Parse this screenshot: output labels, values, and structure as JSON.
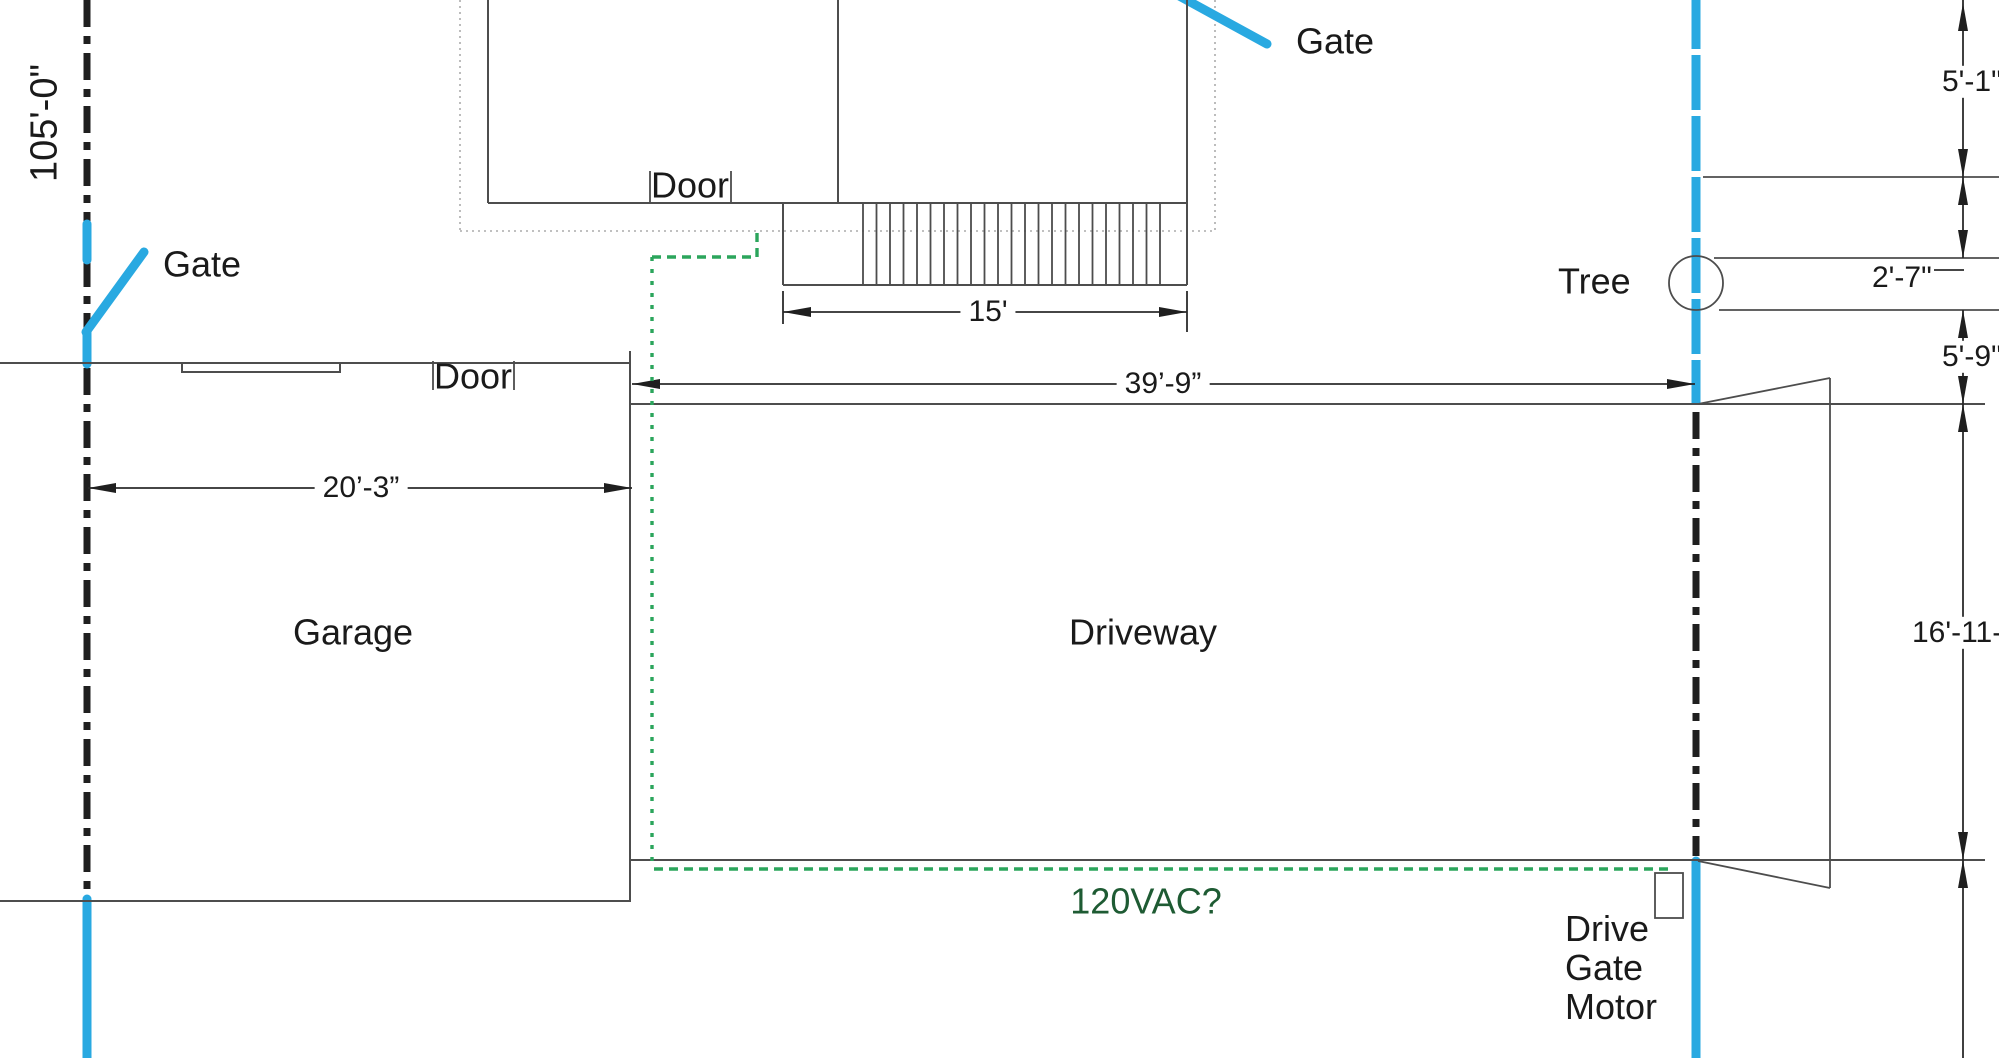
{
  "colors": {
    "fence_blue": "#29A9E1",
    "conduit_green": "#2BA55C",
    "power_text_green": "#1E5B33",
    "property_line_dark": "#1F1F1F",
    "wall_gray": "#4D4D4D"
  },
  "labels": {
    "boundary_length": "105'-0\"",
    "gate_left": "Gate",
    "gate_top": "Gate",
    "door_top": "Door",
    "door_garage": "Door",
    "tree": "Tree",
    "garage": "Garage",
    "driveway": "Driveway",
    "power": "120VAC?",
    "drive_gate_motor": "Drive\nGate\nMotor"
  },
  "dims": {
    "stairs_width": "15'",
    "driveway_length": "39’-9”",
    "garage_width": "20’-3”",
    "right_top": "5'-1\"",
    "tree_offset": "2'-7\"",
    "tree_to_driveway": "5'-9\"",
    "driveway_width": "16'-11-1/2\""
  },
  "shapes": [
    {
      "name": "house-outer-dotted-left",
      "t": "line",
      "x1": 460,
      "y1": 0,
      "x2": 460,
      "y2": 231,
      "cls": "dotted"
    },
    {
      "name": "house-outer-dotted-bottom",
      "t": "line",
      "x1": 460,
      "y1": 231,
      "x2": 1215,
      "y2": 231,
      "cls": "dotted"
    },
    {
      "name": "house-outer-dotted-right",
      "t": "line",
      "x1": 1215,
      "y1": 0,
      "x2": 1215,
      "y2": 231,
      "cls": "dotted"
    },
    {
      "name": "left-property-line-upper",
      "t": "line",
      "x1": 87,
      "y1": 0,
      "x2": 87,
      "y2": 226,
      "cls": "prop"
    },
    {
      "name": "left-property-line-mid",
      "t": "line",
      "x1": 87,
      "y1": 260,
      "x2": 87,
      "y2": 331,
      "cls": "prop"
    },
    {
      "name": "left-property-line-lower",
      "t": "line",
      "x1": 87,
      "y1": 368,
      "x2": 87,
      "y2": 896,
      "cls": "prop"
    },
    {
      "name": "left-fence-blue-upper",
      "t": "line",
      "x1": 87,
      "y1": 224,
      "x2": 87,
      "y2": 260,
      "cls": "blue"
    },
    {
      "name": "left-fence-blue-mid",
      "t": "line",
      "x1": 87,
      "y1": 331,
      "x2": 87,
      "y2": 364,
      "cls": "blue"
    },
    {
      "name": "left-fence-blue-lower",
      "t": "line",
      "x1": 87,
      "y1": 899,
      "x2": 87,
      "y2": 1062,
      "cls": "blue"
    },
    {
      "name": "left-gate-swing-line",
      "t": "line",
      "x1": 86,
      "y1": 332,
      "x2": 144,
      "y2": 252,
      "cls": "blue"
    },
    {
      "name": "right-fence-blue-upper",
      "t": "line",
      "x1": 1696,
      "y1": -6,
      "x2": 1696,
      "y2": 405,
      "cls": "blued"
    },
    {
      "name": "drive-gate-dash-line",
      "t": "line",
      "x1": 1696,
      "y1": 412,
      "x2": 1696,
      "y2": 856,
      "cls": "prop"
    },
    {
      "name": "right-fence-blue-lower",
      "t": "line",
      "x1": 1696,
      "y1": 861,
      "x2": 1696,
      "y2": 1062,
      "cls": "blue"
    },
    {
      "name": "top-gate-swing-line",
      "t": "line",
      "x1": 1172,
      "y1": -8,
      "x2": 1267,
      "y2": 44,
      "cls": "blue"
    },
    {
      "name": "house-left-wall",
      "t": "line",
      "x1": 488,
      "y1": 0,
      "x2": 488,
      "y2": 203,
      "cls": "wall"
    },
    {
      "name": "house-interior-wall",
      "t": "line",
      "x1": 838,
      "y1": 0,
      "x2": 838,
      "y2": 203,
      "cls": "wall"
    },
    {
      "name": "house-right-wall",
      "t": "line",
      "x1": 1187,
      "y1": 0,
      "x2": 1187,
      "y2": 285,
      "cls": "wall"
    },
    {
      "name": "house-bottom-wall",
      "t": "line",
      "x1": 488,
      "y1": 203,
      "x2": 1187,
      "y2": 203,
      "cls": "wall"
    },
    {
      "name": "house-door-jamb-left",
      "t": "line",
      "x1": 650,
      "y1": 171,
      "x2": 650,
      "y2": 203,
      "cls": "thin"
    },
    {
      "name": "house-door-jamb-right",
      "t": "line",
      "x1": 731,
      "y1": 171,
      "x2": 731,
      "y2": 203,
      "cls": "thin"
    },
    {
      "name": "stairs-left-edge",
      "t": "line",
      "x1": 783,
      "y1": 203,
      "x2": 783,
      "y2": 285,
      "cls": "wall"
    },
    {
      "name": "stairs-bottom-edge",
      "t": "line",
      "x1": 783,
      "y1": 285,
      "x2": 1187,
      "y2": 285,
      "cls": "wall"
    },
    {
      "name": "stairs-treads",
      "t": "hatch",
      "x0": 863,
      "x1": 1160,
      "n": 23,
      "y0": 203,
      "y1": 285,
      "cls": "thin"
    },
    {
      "name": "garage-top-edge",
      "t": "line",
      "x1": 0,
      "y1": 363,
      "x2": 630,
      "y2": 363,
      "cls": "wall"
    },
    {
      "name": "garage-window",
      "t": "rect",
      "x": 182,
      "y": 363,
      "w": 158,
      "h": 9,
      "cls": "wall",
      "fill": "#FFFFFF"
    },
    {
      "name": "garage-door-jamb-left",
      "t": "line",
      "x1": 433,
      "y1": 361,
      "x2": 433,
      "y2": 390,
      "cls": "thin"
    },
    {
      "name": "garage-door-jamb-right",
      "t": "line",
      "x1": 514,
      "y1": 361,
      "x2": 514,
      "y2": 390,
      "cls": "thin"
    },
    {
      "name": "garage-right-edge",
      "t": "line",
      "x1": 630,
      "y1": 351,
      "x2": 630,
      "y2": 902,
      "cls": "wall"
    },
    {
      "name": "garage-bottom-edge",
      "t": "line",
      "x1": 0,
      "y1": 901,
      "x2": 630,
      "y2": 901,
      "cls": "wall"
    },
    {
      "name": "driveway-top-edge",
      "t": "line",
      "x1": 630,
      "y1": 404,
      "x2": 1985,
      "y2": 404,
      "cls": "wall"
    },
    {
      "name": "driveway-bottom-edge",
      "t": "line",
      "x1": 630,
      "y1": 860,
      "x2": 1985,
      "y2": 860,
      "cls": "wall"
    },
    {
      "name": "gate-flare-top",
      "t": "line",
      "x1": 1698,
      "y1": 404,
      "x2": 1830,
      "y2": 378,
      "cls": "thin"
    },
    {
      "name": "gate-flare-right",
      "t": "line",
      "x1": 1830,
      "y1": 378,
      "x2": 1830,
      "y2": 888,
      "cls": "thin"
    },
    {
      "name": "gate-flare-bottom",
      "t": "line",
      "x1": 1698,
      "y1": 861,
      "x2": 1830,
      "y2": 888,
      "cls": "thin"
    },
    {
      "name": "tree-upper-ext-line",
      "t": "line",
      "x1": 1703,
      "y1": 177,
      "x2": 1999,
      "y2": 177,
      "cls": "thin"
    },
    {
      "name": "tree-band-top-line",
      "t": "line",
      "x1": 1714,
      "y1": 258,
      "x2": 1999,
      "y2": 258,
      "cls": "thin"
    },
    {
      "name": "tree-band-bottom-line",
      "t": "line",
      "x1": 1719,
      "y1": 310,
      "x2": 1999,
      "y2": 310,
      "cls": "thin"
    },
    {
      "name": "tree-circle",
      "t": "circle",
      "cx": 1696,
      "cy": 283,
      "r": 27,
      "cls": "thin"
    },
    {
      "name": "dim-15-ext-left",
      "t": "line",
      "x1": 783,
      "y1": 291,
      "x2": 783,
      "y2": 324,
      "cls": "dim"
    },
    {
      "name": "dim-15-ext-right",
      "t": "line",
      "x1": 1187,
      "y1": 291,
      "x2": 1187,
      "y2": 332,
      "cls": "dim"
    },
    {
      "name": "dim-15-line",
      "t": "line",
      "x1": 783,
      "y1": 312,
      "x2": 1187,
      "y2": 312,
      "cls": "dim"
    },
    {
      "name": "dim-15-arrow-left",
      "t": "arrow",
      "x": 783,
      "y": 312,
      "dir": "left"
    },
    {
      "name": "dim-15-arrow-right",
      "t": "arrow",
      "x": 1187,
      "y": 312,
      "dir": "right"
    },
    {
      "name": "dim-39-line",
      "t": "line",
      "x1": 632,
      "y1": 384,
      "x2": 1695,
      "y2": 384,
      "cls": "dim"
    },
    {
      "name": "dim-39-arrow-left",
      "t": "arrow",
      "x": 632,
      "y": 384,
      "dir": "left"
    },
    {
      "name": "dim-39-arrow-right",
      "t": "arrow",
      "x": 1695,
      "y": 384,
      "dir": "right"
    },
    {
      "name": "dim-20-line",
      "t": "line",
      "x1": 88,
      "y1": 488,
      "x2": 632,
      "y2": 488,
      "cls": "dim"
    },
    {
      "name": "dim-20-arrow-left",
      "t": "arrow",
      "x": 88,
      "y": 488,
      "dir": "left"
    },
    {
      "name": "dim-20-arrow-right",
      "t": "arrow",
      "x": 632,
      "y": 488,
      "dir": "right"
    },
    {
      "name": "dim-right-chain-seg1",
      "t": "line",
      "x1": 1963,
      "y1": 0,
      "x2": 1963,
      "y2": 177,
      "cls": "dim"
    },
    {
      "name": "dim-right-chain-seg2",
      "t": "line",
      "x1": 1963,
      "y1": 177,
      "x2": 1963,
      "y2": 258,
      "cls": "dim"
    },
    {
      "name": "dim-right-chain-seg3",
      "t": "line",
      "x1": 1963,
      "y1": 310,
      "x2": 1963,
      "y2": 404,
      "cls": "dim"
    },
    {
      "name": "dim-right-chain-seg4",
      "t": "line",
      "x1": 1963,
      "y1": 404,
      "x2": 1963,
      "y2": 860,
      "cls": "dim"
    },
    {
      "name": "dim-right-chain-seg5",
      "t": "line",
      "x1": 1963,
      "y1": 860,
      "x2": 1963,
      "y2": 1058,
      "cls": "dim"
    },
    {
      "name": "dim-2-7-leader",
      "t": "line",
      "x1": 1934,
      "y1": 270,
      "x2": 1964,
      "y2": 270,
      "cls": "dim"
    },
    {
      "name": "dim-arrow-top-up",
      "t": "arrow",
      "x": 1963,
      "y": 3,
      "dir": "up"
    },
    {
      "name": "dim-arrow-177-down",
      "t": "arrow",
      "x": 1963,
      "y": 177,
      "dir": "down"
    },
    {
      "name": "dim-arrow-177-up",
      "t": "arrow",
      "x": 1963,
      "y": 177,
      "dir": "up"
    },
    {
      "name": "dim-arrow-258-down",
      "t": "arrow",
      "x": 1963,
      "y": 258,
      "dir": "down"
    },
    {
      "name": "dim-arrow-310-up",
      "t": "arrow",
      "x": 1963,
      "y": 310,
      "dir": "up"
    },
    {
      "name": "dim-arrow-404-down",
      "t": "arrow",
      "x": 1963,
      "y": 404,
      "dir": "down"
    },
    {
      "name": "dim-arrow-404-up",
      "t": "arrow",
      "x": 1963,
      "y": 404,
      "dir": "up"
    },
    {
      "name": "dim-arrow-860-down",
      "t": "arrow",
      "x": 1963,
      "y": 860,
      "dir": "down"
    },
    {
      "name": "dim-arrow-860-up",
      "t": "arrow",
      "x": 1963,
      "y": 860,
      "dir": "up"
    },
    {
      "name": "conduit-from-door",
      "t": "pline",
      "pts": [
        [
          757,
          233
        ],
        [
          757,
          257
        ],
        [
          652,
          257
        ]
      ],
      "cls": "green"
    },
    {
      "name": "conduit-vertical-run",
      "t": "line",
      "x1": 652,
      "y1": 257,
      "x2": 652,
      "y2": 864,
      "cls": "greendot"
    },
    {
      "name": "conduit-bottom-run",
      "t": "line",
      "x1": 654,
      "y1": 869,
      "x2": 1673,
      "y2": 869,
      "cls": "green"
    },
    {
      "name": "drive-gate-motor-box",
      "t": "rect",
      "x": 1655,
      "y": 873,
      "w": 28,
      "h": 45,
      "cls": "thin",
      "fill": "#FFFFFF"
    }
  ]
}
